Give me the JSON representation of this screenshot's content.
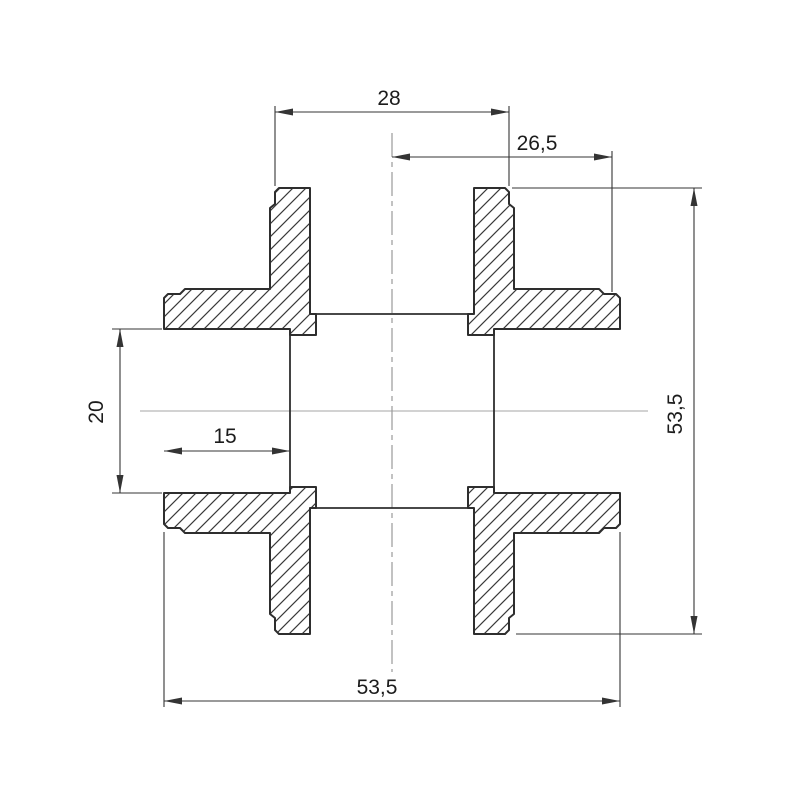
{
  "drawing": {
    "type": "technical-section-drawing",
    "subject": "cross pipe fitting cross-section",
    "colors": {
      "background": "#ffffff",
      "outline": "#2e2e2e",
      "dimension": "#343434",
      "centerline_horizontal": "#b6b6b6",
      "centerline_vertical": "#9a9a9a"
    },
    "dimensions": {
      "top_outer_diameter": "28",
      "center_to_right_edge": "26,5",
      "bore_diameter": "20",
      "socket_depth": "15",
      "overall_height": "53,5",
      "overall_width": "53,5"
    }
  }
}
